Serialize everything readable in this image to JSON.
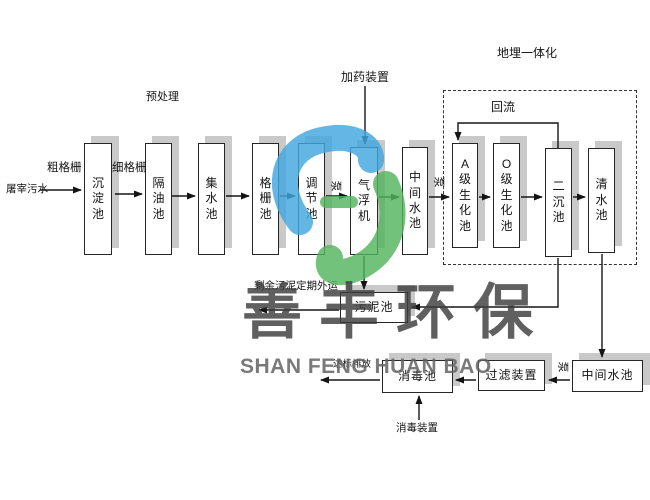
{
  "watermark": {
    "cn": "善丰环保",
    "en": "SHAN FENG HUAN BAO",
    "logo_blue": "#42a6df",
    "logo_green": "#53b45e"
  },
  "diagram": {
    "dashed_box": {
      "x": 443,
      "y": 90,
      "w": 194,
      "h": 175
    },
    "nodes": [
      {
        "id": "sedimentation-tank",
        "label": "沉淀池",
        "x": 84,
        "y": 143,
        "w": 28,
        "h": 112,
        "dir": "v"
      },
      {
        "id": "oil-separation-tank",
        "label": "隔油池",
        "x": 145,
        "y": 143,
        "w": 27,
        "h": 112,
        "dir": "v"
      },
      {
        "id": "collecting-tank",
        "label": "集水池",
        "x": 198,
        "y": 143,
        "w": 27,
        "h": 112,
        "dir": "v"
      },
      {
        "id": "screen-tank",
        "label": "格栅池",
        "x": 252,
        "y": 143,
        "w": 27,
        "h": 112,
        "dir": "v"
      },
      {
        "id": "regulating-tank",
        "label": "调节池",
        "x": 298,
        "y": 143,
        "w": 27,
        "h": 112,
        "dir": "v"
      },
      {
        "id": "air-flotation-machine",
        "label": "气浮机",
        "x": 350,
        "y": 147,
        "w": 28,
        "h": 108,
        "dir": "v"
      },
      {
        "id": "intermediate-tank-1",
        "label": "中间水池",
        "x": 402,
        "y": 147,
        "w": 26,
        "h": 108,
        "dir": "v"
      },
      {
        "id": "a-stage-bio-tank",
        "label": "A级生化池",
        "x": 452,
        "y": 143,
        "w": 26,
        "h": 105,
        "dir": "v"
      },
      {
        "id": "o-stage-bio-tank",
        "label": "O级生化池",
        "x": 493,
        "y": 143,
        "w": 27,
        "h": 105,
        "dir": "v"
      },
      {
        "id": "secondary-sedimentation-tank",
        "label": "二沉池",
        "x": 545,
        "y": 148,
        "w": 27,
        "h": 109,
        "dir": "v"
      },
      {
        "id": "clean-water-tank",
        "label": "清水池",
        "x": 588,
        "y": 148,
        "w": 27,
        "h": 105,
        "dir": "v"
      },
      {
        "id": "sludge-tank",
        "label": "污泥池",
        "x": 340,
        "y": 292,
        "w": 68,
        "h": 31,
        "dir": "h"
      },
      {
        "id": "disinfection-tank",
        "label": "消毒池",
        "x": 382,
        "y": 360,
        "w": 71,
        "h": 33,
        "dir": "h"
      },
      {
        "id": "filter-device",
        "label": "过滤装置",
        "x": 478,
        "y": 360,
        "w": 67,
        "h": 31,
        "dir": "h"
      },
      {
        "id": "intermediate-tank-2",
        "label": "中间水池",
        "x": 572,
        "y": 360,
        "w": 71,
        "h": 32,
        "dir": "h"
      }
    ],
    "labels": [
      {
        "id": "influent",
        "text": "屠宰污水",
        "x": 6,
        "y": 184
      },
      {
        "id": "coarse-screen",
        "text": "粗格栅",
        "x": 47,
        "y": 162
      },
      {
        "id": "fine-screen",
        "text": "细格栅",
        "x": 112,
        "y": 162
      },
      {
        "id": "pretreatment",
        "text": "预处理",
        "x": 146,
        "y": 91
      },
      {
        "id": "dosing-device",
        "text": "加药装置",
        "x": 341,
        "y": 71
      },
      {
        "id": "buried-integration",
        "text": "地埋一体化",
        "x": 497,
        "y": 47
      },
      {
        "id": "reflux",
        "text": "回流",
        "x": 491,
        "y": 101
      },
      {
        "id": "sludge-out",
        "text": "剩余污泥定期外运",
        "x": 254,
        "y": 281
      },
      {
        "id": "discharge",
        "text": "达标排放",
        "x": 333,
        "y": 360
      },
      {
        "id": "disinfect-device",
        "text": "消毒装置",
        "x": 396,
        "y": 423
      },
      {
        "id": "pump-1",
        "text": "泵",
        "x": 330,
        "y": 180,
        "rot": 1
      },
      {
        "id": "pump-2",
        "text": "泵",
        "x": 433,
        "y": 176,
        "rot": 1
      },
      {
        "id": "pump-3",
        "text": "泵",
        "x": 557,
        "y": 361,
        "rot": 1
      }
    ],
    "connectors": [
      {
        "id": "influent-to-sedimentation",
        "points": [
          [
            40,
            190
          ],
          [
            81,
            190
          ]
        ]
      },
      {
        "id": "sedimentation-to-oil",
        "points": [
          [
            115,
            194
          ],
          [
            142,
            194
          ]
        ]
      },
      {
        "id": "oil-to-collecting",
        "points": [
          [
            172,
            196
          ],
          [
            195,
            196
          ]
        ]
      },
      {
        "id": "collecting-to-screen",
        "points": [
          [
            226,
            196
          ],
          [
            249,
            196
          ]
        ]
      },
      {
        "id": "screen-to-regulating",
        "points": [
          [
            280,
            196
          ],
          [
            295,
            196
          ]
        ]
      },
      {
        "id": "regulating-to-flotation",
        "points": [
          [
            326,
            196
          ],
          [
            347,
            196
          ]
        ]
      },
      {
        "id": "flotation-to-intermediate1",
        "points": [
          [
            379,
            197
          ],
          [
            399,
            197
          ]
        ]
      },
      {
        "id": "intermediate1-to-a-stage",
        "points": [
          [
            429,
            197
          ],
          [
            449,
            197
          ]
        ]
      },
      {
        "id": "a-stage-to-o-stage",
        "points": [
          [
            479,
            197
          ],
          [
            490,
            197
          ]
        ]
      },
      {
        "id": "o-stage-to-secondary",
        "points": [
          [
            521,
            197
          ],
          [
            542,
            197
          ]
        ]
      },
      {
        "id": "secondary-to-clean",
        "points": [
          [
            573,
            197
          ],
          [
            585,
            197
          ]
        ]
      },
      {
        "id": "dosing-down-to-flotation",
        "points": [
          [
            365,
            86
          ],
          [
            365,
            144
          ]
        ]
      },
      {
        "id": "reflux-line",
        "points": [
          [
            558,
            148
          ],
          [
            558,
            123
          ],
          [
            458,
            123
          ],
          [
            458,
            140
          ]
        ]
      },
      {
        "id": "flotation-down-to-sludge",
        "points": [
          [
            364,
            256
          ],
          [
            364,
            289
          ]
        ]
      },
      {
        "id": "secondary-down-to-sludge",
        "points": [
          [
            558,
            258
          ],
          [
            558,
            307
          ],
          [
            412,
            307
          ]
        ]
      },
      {
        "id": "sludge-out-arrow",
        "points": [
          [
            339,
            310
          ],
          [
            259,
            310
          ]
        ]
      },
      {
        "id": "clean-down-to-intermediate2",
        "points": [
          [
            602,
            254
          ],
          [
            602,
            357
          ]
        ]
      },
      {
        "id": "intermediate2-to-filter",
        "points": [
          [
            570,
            380
          ],
          [
            549,
            380
          ]
        ]
      },
      {
        "id": "filter-to-disinfection",
        "points": [
          [
            476,
            380
          ],
          [
            456,
            380
          ]
        ]
      },
      {
        "id": "disinfection-to-discharge",
        "points": [
          [
            380,
            380
          ],
          [
            321,
            380
          ]
        ]
      },
      {
        "id": "disinfect-device-up",
        "points": [
          [
            419,
            420
          ],
          [
            419,
            396
          ]
        ]
      }
    ]
  }
}
